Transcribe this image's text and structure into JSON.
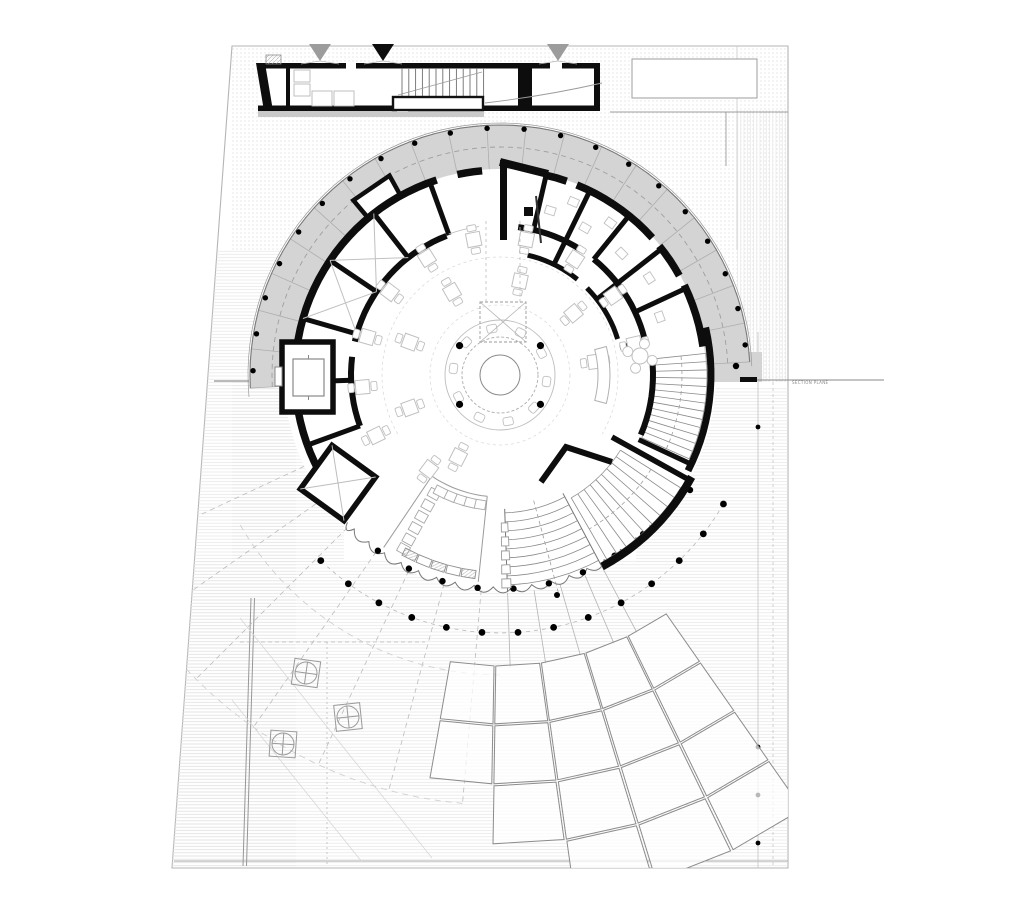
{
  "annotations": {
    "section_plane_label": "SECTION PLANE"
  },
  "colors": {
    "background": "#ffffff",
    "site_line": "#b5b5b5",
    "wall": "#0d0d0d",
    "terrace_band": "#d4d4d4",
    "band_line": "#787878",
    "tick": "#aeaeae",
    "dash": "#9f9f9f",
    "thin": "#8f8f8f",
    "furniture": "#c0c0c0",
    "furniture_dark": "#999999",
    "tread": "#8a8a8a",
    "column": "#000000",
    "panel": "#8c8c8c",
    "hatch_line": "#e4e4e4",
    "hatch_dot": "#d9d9d9",
    "light_arc": "#d0d0d0",
    "gray_fill": "#c9c9c9",
    "marker_gray": "#9c9c9c"
  },
  "plan": {
    "canvas": {
      "w": 1024,
      "h": 924
    },
    "center": {
      "x": 500,
      "y": 375
    },
    "site": {
      "outline": [
        [
          232,
          46
        ],
        [
          788,
          46
        ],
        [
          788,
          868
        ],
        [
          172,
          868
        ]
      ],
      "inner_bottom_line_y": 861,
      "left_inner_wall": [
        [
          251,
          598
        ],
        [
          243,
          866
        ]
      ],
      "right_col_line": {
        "x": 758,
        "y1": 332,
        "y2": 868,
        "dots_y": [
          372,
          427,
          747,
          795,
          843
        ]
      },
      "right_dash_line": {
        "x": 773,
        "y1": 382,
        "y2": 868
      },
      "inner_v_line": {
        "x": 737,
        "y1": 46,
        "y2": 250
      }
    },
    "terrace_band": {
      "r_outer": 250,
      "r_inner": 206,
      "a_start": 177,
      "a_end": 357,
      "tick_count": 20,
      "dashed_r": 228,
      "outer_line_r": 252,
      "dots": {
        "r": 247,
        "a_start": 181,
        "a_end": 353,
        "count": 21,
        "size": 2.7
      },
      "end_block": [
        714,
        352,
        48,
        30
      ],
      "bump": {
        "a1": 230,
        "a2": 241,
        "r1": 205,
        "r2": 228
      }
    },
    "outer_wall": {
      "r": 205,
      "w": 7.5,
      "segments": [
        [
          152,
          252
        ],
        [
          258,
          265
        ],
        [
          283,
          289
        ],
        [
          292,
          318
        ],
        [
          321,
          331
        ],
        [
          334,
          352
        ]
      ]
    },
    "inner_wall": {
      "r": 149,
      "w": 6,
      "segments": [
        [
          160,
          187
        ],
        [
          193,
          249
        ],
        [
          277,
          303
        ],
        [
          309,
          349
        ]
      ]
    },
    "inner_wall2": {
      "r": 123,
      "w": 5,
      "segments": [
        [
          283,
          309
        ],
        [
          315,
          343
        ]
      ]
    },
    "radial_walls": [
      {
        "a": 160,
        "r1": 149,
        "r2": 205
      },
      {
        "a": 178,
        "r1": 149,
        "r2": 205
      },
      {
        "a": 196,
        "r1": 149,
        "r2": 205
      },
      {
        "a": 214,
        "r1": 149,
        "r2": 205
      },
      {
        "a": 232,
        "r1": 149,
        "r2": 205
      },
      {
        "a": 250,
        "r1": 149,
        "r2": 205
      },
      {
        "a": 283,
        "r1": 149,
        "r2": 205
      },
      {
        "a": 296,
        "r1": 123,
        "r2": 205
      },
      {
        "a": 309,
        "r1": 149,
        "r2": 205
      },
      {
        "a": 322,
        "r1": 123,
        "r2": 205
      },
      {
        "a": 335,
        "r1": 149,
        "r2": 205
      },
      {
        "a": 347,
        "r1": 123,
        "r2": 149
      }
    ],
    "x_rooms": [
      {
        "a1": 196,
        "a2": 214
      },
      {
        "a1": 214,
        "a2": 232
      }
    ],
    "diamond_room": {
      "cx": 338,
      "cy": 483,
      "size": 54,
      "rot": 36
    },
    "elevator": {
      "outer": [
        282,
        342,
        51,
        70
      ],
      "inner": [
        293,
        359,
        31,
        37
      ],
      "side": [
        275,
        367,
        7,
        19
      ]
    },
    "notch": {
      "v_wall": [
        500,
        160,
        7,
        80
      ],
      "top_wall": [
        [
          500,
          162
        ],
        [
          548,
          174
        ]
      ],
      "pivot": [
        524,
        207,
        9,
        9
      ],
      "partition": [
        [
          536,
          196
        ],
        [
          541,
          243
        ]
      ]
    },
    "central_bar": {
      "r_inner": 20,
      "r_mid": 38,
      "r_outer": 55,
      "stool_r": 47,
      "stool_count": 10,
      "col_dots": {
        "r": 50,
        "angles": [
          36,
          144,
          216,
          324
        ],
        "size": 3.6
      }
    },
    "void_shaft": {
      "rect": [
        480,
        302,
        46,
        40
      ],
      "lines_to_y": 218
    },
    "bench": {
      "a1": -15,
      "a2": 15,
      "r1": 98,
      "r2": 110
    },
    "round_table": {
      "cx": 640,
      "cy": 356,
      "r_big": 8,
      "r_small": 5,
      "sat_r": 13
    },
    "tables": {
      "ring1": {
        "r": 96,
        "angles": [
          160,
          200,
          240,
          282,
          320,
          352
        ]
      },
      "ring2": {
        "r": 138,
        "angles": [
          154,
          175,
          196,
          217,
          238,
          259,
          281,
          303,
          325,
          347
        ]
      },
      "extra": [
        {
          "a": 127,
          "r": 118
        },
        {
          "a": 117,
          "r": 92
        }
      ],
      "size": 14
    },
    "side_desks": [
      {
        "a": 287,
        "r": 172
      },
      {
        "a": 293,
        "r": 188
      },
      {
        "a": 300,
        "r": 170
      },
      {
        "a": 306,
        "r": 188
      },
      {
        "a": 315,
        "r": 172
      },
      {
        "a": 327,
        "r": 178
      },
      {
        "a": 340,
        "r": 170
      }
    ],
    "stair_east": {
      "outer": {
        "r": 211,
        "a1": -13,
        "a2": 27
      },
      "inner": {
        "r": 153,
        "a1": -4,
        "a2": 23
      },
      "treads": {
        "r1": 155,
        "r2": 207,
        "a1": -6,
        "a2": 24,
        "step": 2.3
      },
      "rails": [
        155,
        207
      ],
      "dash_r": 182,
      "end_wall": {
        "a": 25,
        "r1": 153,
        "r2": 211
      },
      "dots": [
        [
          736,
          366
        ],
        [
          690,
          490
        ]
      ]
    },
    "stair_se": {
      "arc": {
        "r": 217,
        "a1": 28,
        "a2": 62,
        "w": 8
      },
      "side_wall": {
        "a": 29,
        "r1": 128,
        "r2": 216
      },
      "treads": {
        "r1": 142,
        "r2": 213,
        "a1": 32,
        "a2": 60,
        "step": 3.1
      },
      "rails": [
        142,
        213
      ],
      "dash_r": 178,
      "chevron": [
        [
          541,
          482
        ],
        [
          566,
          447
        ],
        [
          612,
          462
        ]
      ]
    },
    "stair_s": {
      "a1": 62,
      "a2": 88,
      "r1": 138,
      "r2": 212,
      "tread_step": 9,
      "dash_a": 75,
      "balustrade": {
        "a": 87,
        "a2": 89.5,
        "radii": [
          148,
          162,
          176,
          190,
          204
        ]
      }
    },
    "glass": {
      "r": 212,
      "a1": 45,
      "a2": 136,
      "scallop_step": 5.2,
      "ctrl_r": 224,
      "dots": {
        "r": 214,
        "a1": 48,
        "a2": 134,
        "step": 9.6,
        "size": 3.2
      }
    },
    "counter": {
      "a1": 96,
      "a2": 124,
      "r_in": 122,
      "r_out": 208,
      "radial_rects": {
        "a": 119,
        "radii": [
          136,
          149,
          162,
          175,
          188,
          199
        ]
      },
      "arc_rects": {
        "r": 131,
        "angles": [
          99,
          103.5,
          108,
          112.5,
          117
        ]
      },
      "cabinets": {
        "r": 201,
        "angles": [
          99,
          103.4,
          107.8,
          112.2,
          116.6
        ],
        "gray": [
          0,
          2,
          4
        ]
      }
    },
    "south": {
      "col_arc": {
        "r": 258,
        "a1": 30,
        "a2": 140,
        "step": 8,
        "size": 3.4
      },
      "dash_arc": {
        "r": 258,
        "a1": 30,
        "a2": 132
      },
      "radial_dash": [
        95,
        105,
        115,
        125,
        135,
        145,
        155
      ],
      "radial_solid": [
        62,
        67,
        74,
        81,
        88
      ],
      "big_arcs": [
        {
          "r": 300,
          "a1": 90,
          "a2": 150
        },
        {
          "r": 430,
          "a1": 95,
          "a2": 138
        }
      ],
      "trees": [
        {
          "x": 306,
          "y": 673,
          "rot": 8
        },
        {
          "x": 348,
          "y": 717,
          "rot": -6
        },
        {
          "x": 283,
          "y": 744,
          "rot": 4
        }
      ],
      "h_dash_line": {
        "y": 642,
        "x1": 240,
        "x2": 425
      },
      "v_dash_line": {
        "x": 327,
        "y1": 642,
        "y2": 866
      },
      "diag_lines": [
        [
          [
            240,
            618
          ],
          [
            432,
            858
          ]
        ],
        [
          [
            232,
            700
          ],
          [
            362,
            862
          ]
        ]
      ],
      "extra_dots": [
        [
          502,
          508
        ],
        [
          443,
          538
        ],
        [
          532,
          547
        ],
        [
          557,
          595
        ],
        [
          590,
          455
        ],
        [
          462,
          163
        ]
      ]
    },
    "panels": {
      "a_cols": [
        100,
        91,
        82,
        73,
        64,
        55
      ],
      "r_rows": [
        290,
        350,
        410,
        470,
        530
      ],
      "limits": [
        2,
        3,
        4,
        4,
        4
      ],
      "inset": 2.5
    },
    "hall_arcs": [
      {
        "r": 70,
        "a1": 0,
        "a2": 360
      },
      {
        "r": 118,
        "a1": 150,
        "a2": 390
      }
    ],
    "linear_building": {
      "rect": [
        258,
        63,
        342,
        48
      ],
      "top_wall_gaps": [
        [
          346,
          10
        ],
        [
          550,
          12
        ]
      ],
      "bottom_wall_gap": [
        397,
        11
      ],
      "gray_strip": [
        258,
        111,
        226,
        6
      ],
      "walls_v": [
        [
          286,
          63,
          4,
          48
        ],
        [
          518,
          63,
          14,
          48
        ],
        [
          594,
          63,
          6,
          48
        ]
      ],
      "stair": {
        "x1": 402,
        "x2": 484,
        "y1": 68,
        "y2": 97,
        "step": 6.8,
        "landing": [
          393,
          97,
          90,
          13
        ],
        "break_line": [
          [
            398,
            95
          ],
          [
            482,
            72
          ]
        ]
      },
      "furniture": [
        [
          294,
          70,
          16,
          12
        ],
        [
          294,
          84,
          16,
          12
        ],
        [
          312,
          91,
          20,
          15
        ],
        [
          334,
          91,
          20,
          15
        ]
      ],
      "chimney": [
        266,
        55,
        15,
        9
      ],
      "curve": [
        [
          485,
          103
        ],
        [
          545,
          96
        ],
        [
          602,
          83
        ]
      ],
      "markers": [
        {
          "x": 320,
          "y": 44,
          "fill": "gray"
        },
        {
          "x": 383,
          "y": 44,
          "fill": "black"
        },
        {
          "x": 558,
          "y": 44,
          "fill": "gray"
        }
      ]
    },
    "ne_rect": [
      632,
      59,
      125,
      39
    ],
    "ne_lines": {
      "h": [
        610,
        112,
        788
      ],
      "v": [
        726,
        112,
        166
      ]
    },
    "section_plane": {
      "left": [
        214,
        381,
        249,
        381
      ],
      "thick": [
        740,
        377,
        17,
        5
      ],
      "line": [
        757,
        380,
        884,
        380
      ],
      "label_x": 792,
      "label_y": 384
    }
  }
}
